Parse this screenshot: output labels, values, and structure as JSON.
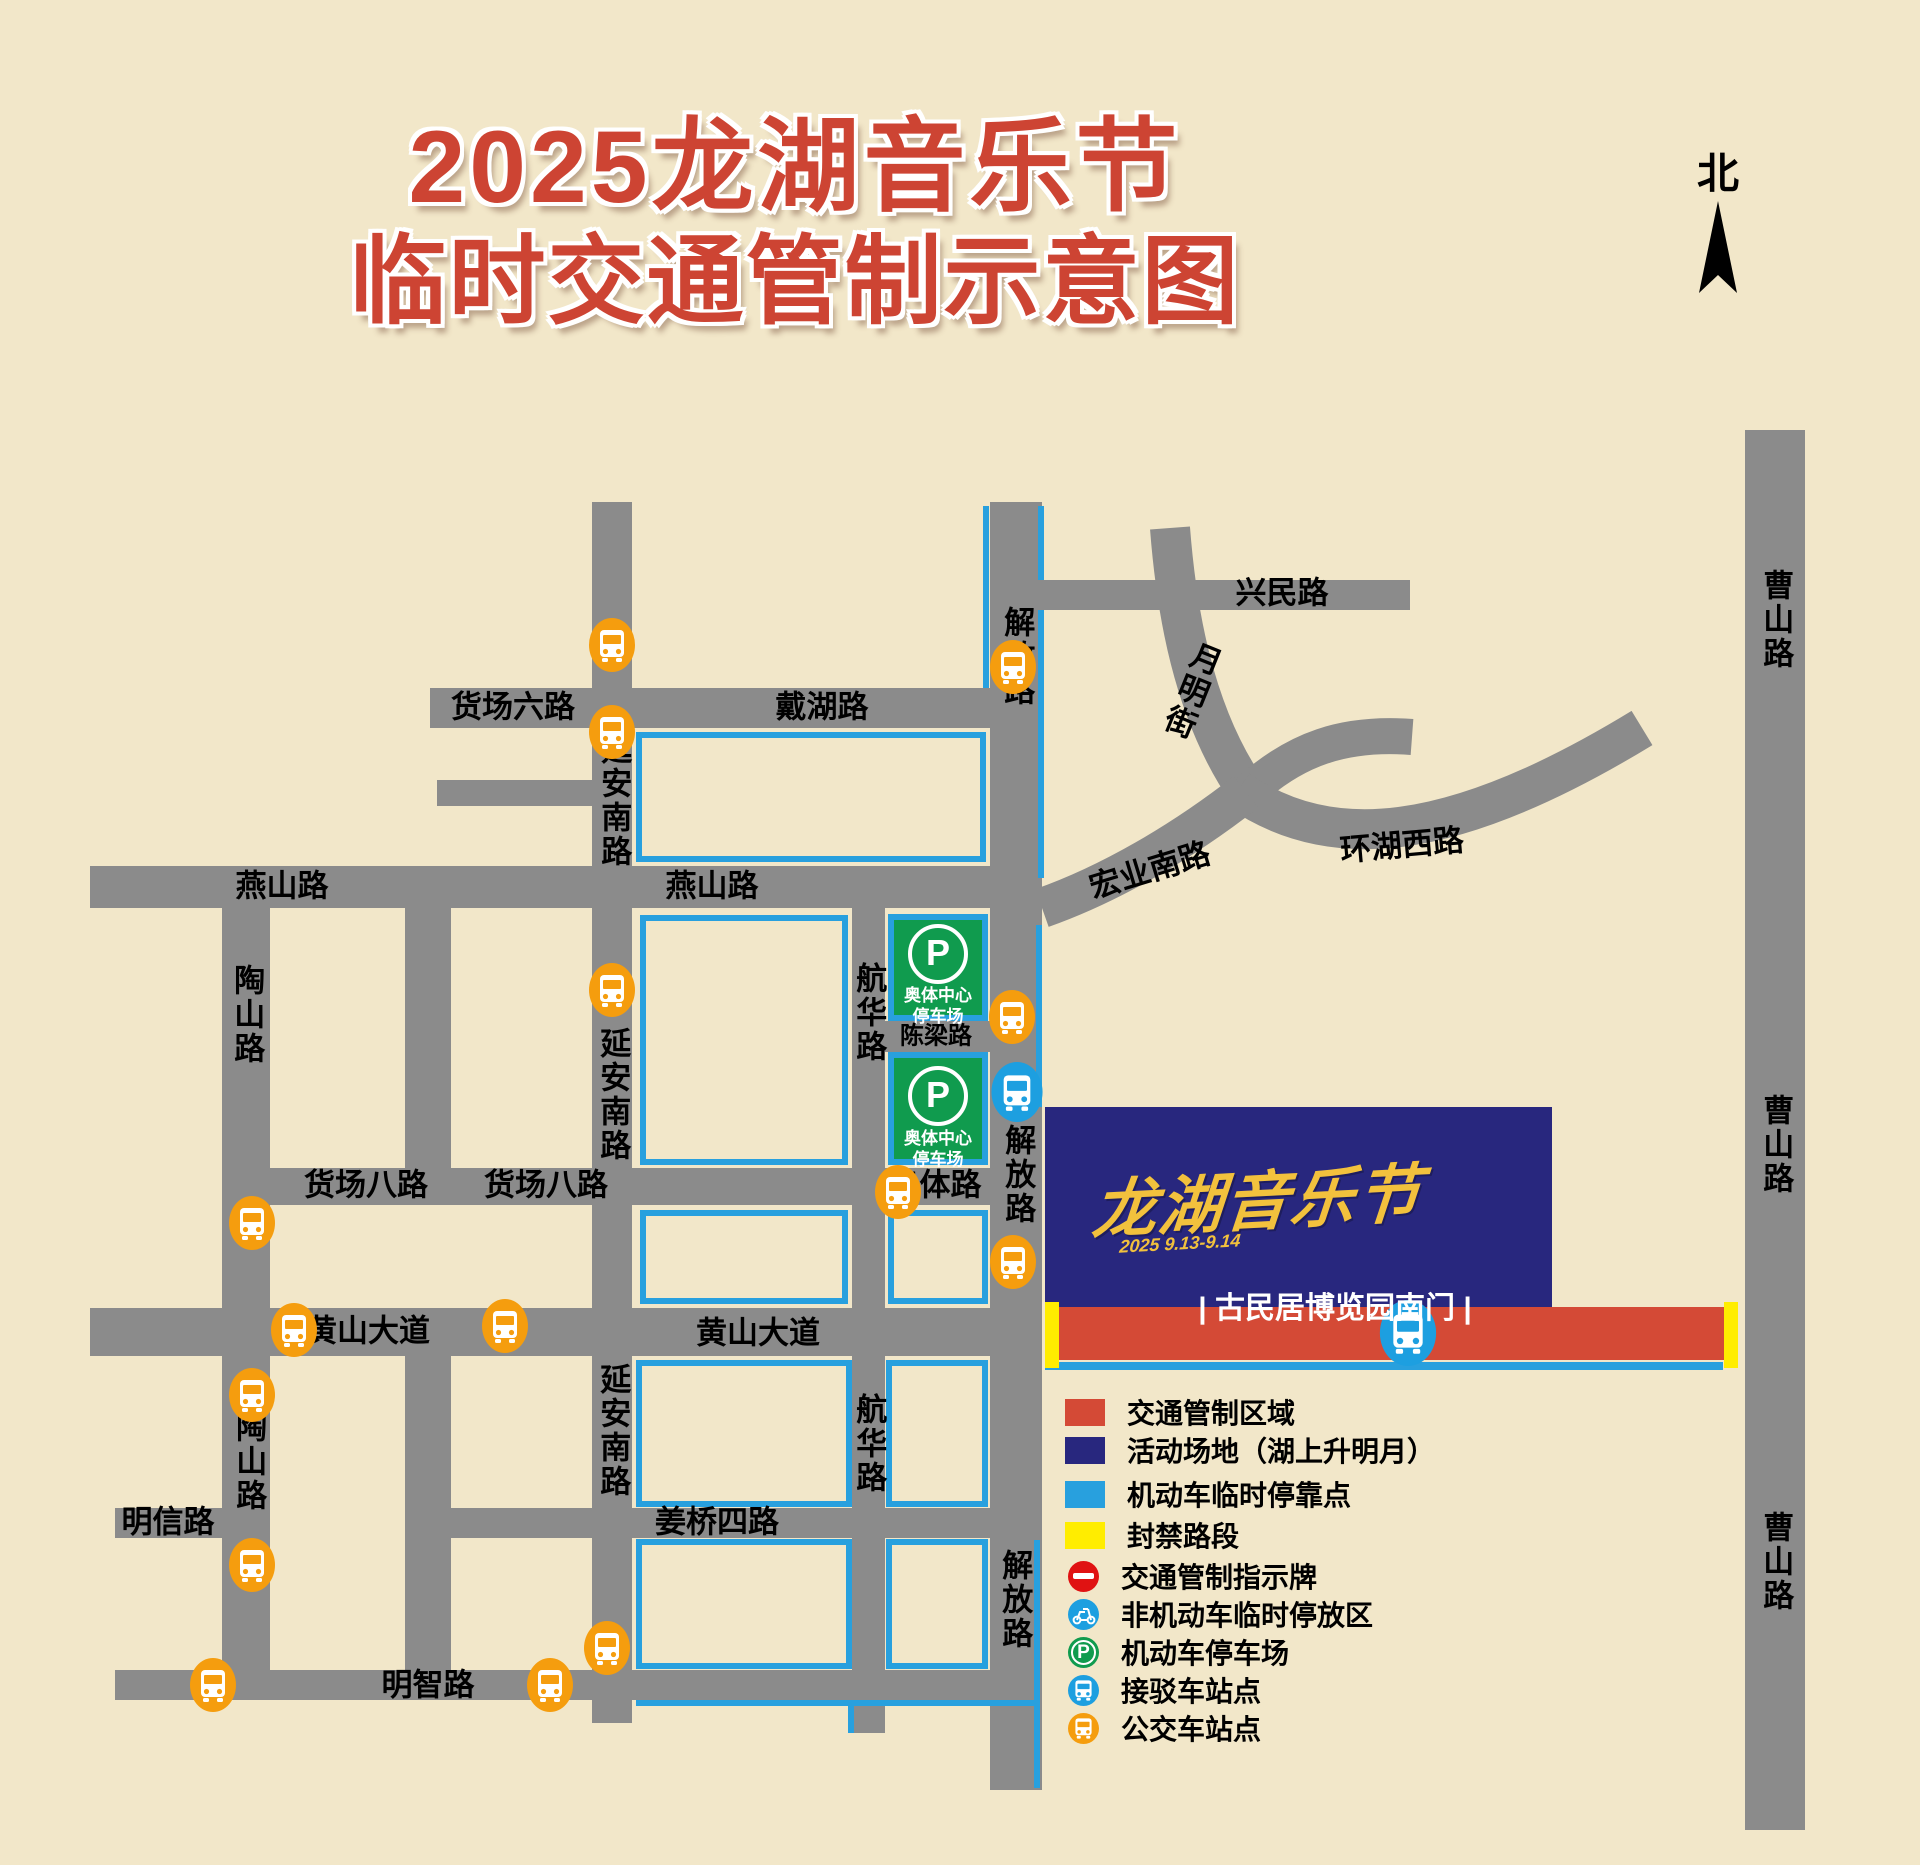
{
  "title": {
    "line1": "2025龙湖音乐节",
    "line2": "临时交通管制示意图"
  },
  "compass": {
    "label": "北"
  },
  "colors": {
    "background": "#f2e7c9",
    "road": "#8b8b8b",
    "curb_blue": "#28a0de",
    "control_red": "#d44a36",
    "event_navy": "#28277e",
    "closed_yellow": "#ffed00",
    "parking_green": "#109b4e",
    "bus_orange": "#f59d0e",
    "shuttle_blue": "#1d9fe0",
    "sign_red": "#e01212",
    "title_red": "#cd4433"
  },
  "map": {
    "roads": [
      {
        "name": "xingmin-road",
        "x": 1042,
        "y": 580,
        "w": 368,
        "h": 30
      },
      {
        "name": "daihu-huochangliu-road",
        "x": 430,
        "y": 688,
        "w": 612,
        "h": 40
      },
      {
        "name": "west-stub-road",
        "x": 437,
        "y": 780,
        "w": 156,
        "h": 26
      },
      {
        "name": "yanshan-road",
        "x": 90,
        "y": 866,
        "w": 952,
        "h": 42
      },
      {
        "name": "huochangba-aoti-road",
        "x": 270,
        "y": 1168,
        "w": 772,
        "h": 37
      },
      {
        "name": "huangshan-avenue",
        "x": 90,
        "y": 1308,
        "w": 952,
        "h": 48
      },
      {
        "name": "mingxin-road",
        "x": 115,
        "y": 1508,
        "w": 107,
        "h": 30
      },
      {
        "name": "jiangqiaosi-road",
        "x": 405,
        "y": 1508,
        "w": 637,
        "h": 30
      },
      {
        "name": "mingzhi-road",
        "x": 115,
        "y": 1670,
        "w": 927,
        "h": 30
      },
      {
        "name": "chenliang-road",
        "x": 885,
        "y": 1021,
        "w": 105,
        "h": 31
      },
      {
        "name": "taoshan-road",
        "x": 222,
        "y": 908,
        "w": 48,
        "h": 792
      },
      {
        "name": "mid-road-north",
        "x": 405,
        "y": 908,
        "w": 46,
        "h": 262
      },
      {
        "name": "mid-road-south",
        "x": 405,
        "y": 1356,
        "w": 46,
        "h": 316
      },
      {
        "name": "yanan-south-road",
        "x": 592,
        "y": 502,
        "w": 40,
        "h": 1221
      },
      {
        "name": "hanghua-road",
        "x": 852,
        "y": 908,
        "w": 33,
        "h": 825
      },
      {
        "name": "jiefang-road",
        "x": 990,
        "y": 502,
        "w": 52,
        "h": 1288
      },
      {
        "name": "caoshan-road",
        "x": 1745,
        "y": 430,
        "w": 60,
        "h": 1400
      }
    ],
    "curves": [
      {
        "name": "yueming-street",
        "path": "M 1170 528 C 1176 606, 1192 712, 1248 792",
        "width": 40
      },
      {
        "name": "yueming-branch",
        "path": "M 1246 794 C 1295 748, 1345 732, 1412 737",
        "width": 36
      },
      {
        "name": "huanhu-west-road",
        "path": "M 1238 790 C 1330 854, 1452 844, 1642 728",
        "width": 40
      },
      {
        "name": "hongye-south-road",
        "path": "M 1042 908 C 1110 884, 1182 842, 1246 792",
        "width": 40
      }
    ],
    "curb_blocks": [
      {
        "x": 636,
        "y": 732,
        "w": 350,
        "h": 130
      },
      {
        "x": 640,
        "y": 915,
        "w": 208,
        "h": 250
      },
      {
        "x": 640,
        "y": 1210,
        "w": 208,
        "h": 94
      },
      {
        "x": 888,
        "y": 1210,
        "w": 100,
        "h": 94
      },
      {
        "x": 636,
        "y": 1360,
        "w": 216,
        "h": 147
      },
      {
        "x": 886,
        "y": 1360,
        "w": 102,
        "h": 147
      },
      {
        "x": 636,
        "y": 1539,
        "w": 216,
        "h": 130
      },
      {
        "x": 886,
        "y": 1539,
        "w": 102,
        "h": 130
      }
    ],
    "curb_lines": [
      {
        "x": 983,
        "y": 506,
        "w": 6,
        "h": 182
      },
      {
        "x": 1038,
        "y": 506,
        "w": 6,
        "h": 74
      },
      {
        "x": 1038,
        "y": 610,
        "w": 6,
        "h": 268
      },
      {
        "x": 1036,
        "y": 925,
        "w": 6,
        "h": 182
      },
      {
        "x": 1045,
        "y": 1362,
        "w": 678,
        "h": 8
      },
      {
        "x": 636,
        "y": 1700,
        "w": 400,
        "h": 6
      },
      {
        "x": 848,
        "y": 1700,
        "w": 6,
        "h": 33
      },
      {
        "x": 1034,
        "y": 1540,
        "w": 6,
        "h": 248
      }
    ],
    "parking_lots": [
      {
        "x": 888,
        "y": 914,
        "w": 100,
        "h": 107,
        "icon": "P",
        "line1": "奥体中心",
        "line2": "停车场"
      },
      {
        "x": 888,
        "y": 1052,
        "w": 100,
        "h": 113,
        "icon": "P",
        "line1": "奥体中心",
        "line2": "停车场"
      }
    ],
    "labels": [
      {
        "text": "兴民路",
        "x": 1282,
        "y": 594
      },
      {
        "text": "货场六路",
        "x": 513,
        "y": 708
      },
      {
        "text": "戴湖路",
        "x": 822,
        "y": 708
      },
      {
        "text": "月明街",
        "x": 1190,
        "y": 690,
        "vert": true,
        "rot": 22
      },
      {
        "text": "宏业南路",
        "x": 1150,
        "y": 871,
        "rot": -17
      },
      {
        "text": "环湖西路",
        "x": 1402,
        "y": 846,
        "rot": -5
      },
      {
        "text": "燕山路",
        "x": 282,
        "y": 887
      },
      {
        "text": "燕山路",
        "x": 712,
        "y": 887
      },
      {
        "text": "延安南路",
        "x": 613,
        "y": 801,
        "vert": true
      },
      {
        "text": "延安南路",
        "x": 612,
        "y": 1095,
        "vert": true
      },
      {
        "text": "延安南路",
        "x": 612,
        "y": 1431,
        "vert": true
      },
      {
        "text": "陶山路",
        "x": 246,
        "y": 1015,
        "vert": true
      },
      {
        "text": "陶山路",
        "x": 248,
        "y": 1462,
        "vert": true
      },
      {
        "text": "航华路",
        "x": 868,
        "y": 1013,
        "vert": true
      },
      {
        "text": "航华路",
        "x": 868,
        "y": 1444,
        "vert": true
      },
      {
        "text": "解放路",
        "x": 1016,
        "y": 657,
        "vert": true
      },
      {
        "text": "解放路",
        "x": 1017,
        "y": 1175,
        "vert": true
      },
      {
        "text": "解放路",
        "x": 1014,
        "y": 1600,
        "vert": true
      },
      {
        "text": "货场八路",
        "x": 366,
        "y": 1186
      },
      {
        "text": "货场八路",
        "x": 546,
        "y": 1186
      },
      {
        "text": "奥体路",
        "x": 935,
        "y": 1186
      },
      {
        "text": "陈梁路",
        "x": 936,
        "y": 1036,
        "size": 24
      },
      {
        "text": "黄山大道",
        "x": 368,
        "y": 1332
      },
      {
        "text": "黄山大道",
        "x": 758,
        "y": 1334
      },
      {
        "text": "明信路",
        "x": 168,
        "y": 1523
      },
      {
        "text": "姜桥四路",
        "x": 717,
        "y": 1523
      },
      {
        "text": "明智路",
        "x": 428,
        "y": 1686
      },
      {
        "text": "曹山路",
        "x": 1775,
        "y": 620,
        "vert": true
      },
      {
        "text": "曹山路",
        "x": 1775,
        "y": 1145,
        "vert": true
      },
      {
        "text": "曹山路",
        "x": 1775,
        "y": 1562,
        "vert": true
      }
    ],
    "event_area": {
      "x": 1045,
      "y": 1107,
      "w": 507,
      "h": 200,
      "logo": "龙湖音乐节",
      "dates": "2025 9.13-9.14",
      "gate_label": "| 古民居博览园南门 |",
      "gate_x": 1335,
      "gate_y": 1305
    },
    "control_bar": {
      "x": 1059,
      "y": 1307,
      "w": 665,
      "h": 53
    },
    "closed_caps": [
      {
        "x": 1045,
        "y": 1302,
        "w": 14,
        "h": 66
      },
      {
        "x": 1724,
        "y": 1302,
        "w": 14,
        "h": 66
      }
    ],
    "bus_stops": [
      {
        "x": 612,
        "y": 645
      },
      {
        "x": 612,
        "y": 732
      },
      {
        "x": 1013,
        "y": 667
      },
      {
        "x": 612,
        "y": 990
      },
      {
        "x": 1012,
        "y": 1017
      },
      {
        "x": 898,
        "y": 1192
      },
      {
        "x": 1013,
        "y": 1262
      },
      {
        "x": 252,
        "y": 1223
      },
      {
        "x": 294,
        "y": 1330
      },
      {
        "x": 505,
        "y": 1326
      },
      {
        "x": 252,
        "y": 1395
      },
      {
        "x": 252,
        "y": 1565
      },
      {
        "x": 213,
        "y": 1685
      },
      {
        "x": 550,
        "y": 1685
      },
      {
        "x": 607,
        "y": 1648
      }
    ],
    "shuttle_stops": [
      {
        "x": 1017,
        "y": 1092,
        "d": 60
      },
      {
        "x": 1408,
        "y": 1333,
        "d": 66
      }
    ]
  },
  "legend": {
    "x": 1065,
    "items": [
      {
        "kind": "square",
        "color": "#d44a36",
        "label": "交通管制区域",
        "y": 1412
      },
      {
        "kind": "square",
        "color": "#28277e",
        "label": "活动场地（湖上升明月）",
        "y": 1450
      },
      {
        "kind": "square",
        "color": "#28a0de",
        "label": "机动车临时停靠点",
        "y": 1494
      },
      {
        "kind": "square",
        "color": "#ffed00",
        "label": "封禁路段",
        "y": 1535
      },
      {
        "kind": "noentry",
        "color": "#e01212",
        "label": "交通管制指示牌",
        "y": 1576
      },
      {
        "kind": "scooter",
        "color": "#1d9fe0",
        "label": "非机动车临时停放区",
        "y": 1614
      },
      {
        "kind": "parking",
        "color": "#109b4e",
        "label": "机动车停车场",
        "y": 1652
      },
      {
        "kind": "shuttle",
        "color": "#1d9fe0",
        "label": "接驳车站点",
        "y": 1690
      },
      {
        "kind": "bus",
        "color": "#f59d0e",
        "label": "公交车站点",
        "y": 1728
      }
    ]
  }
}
